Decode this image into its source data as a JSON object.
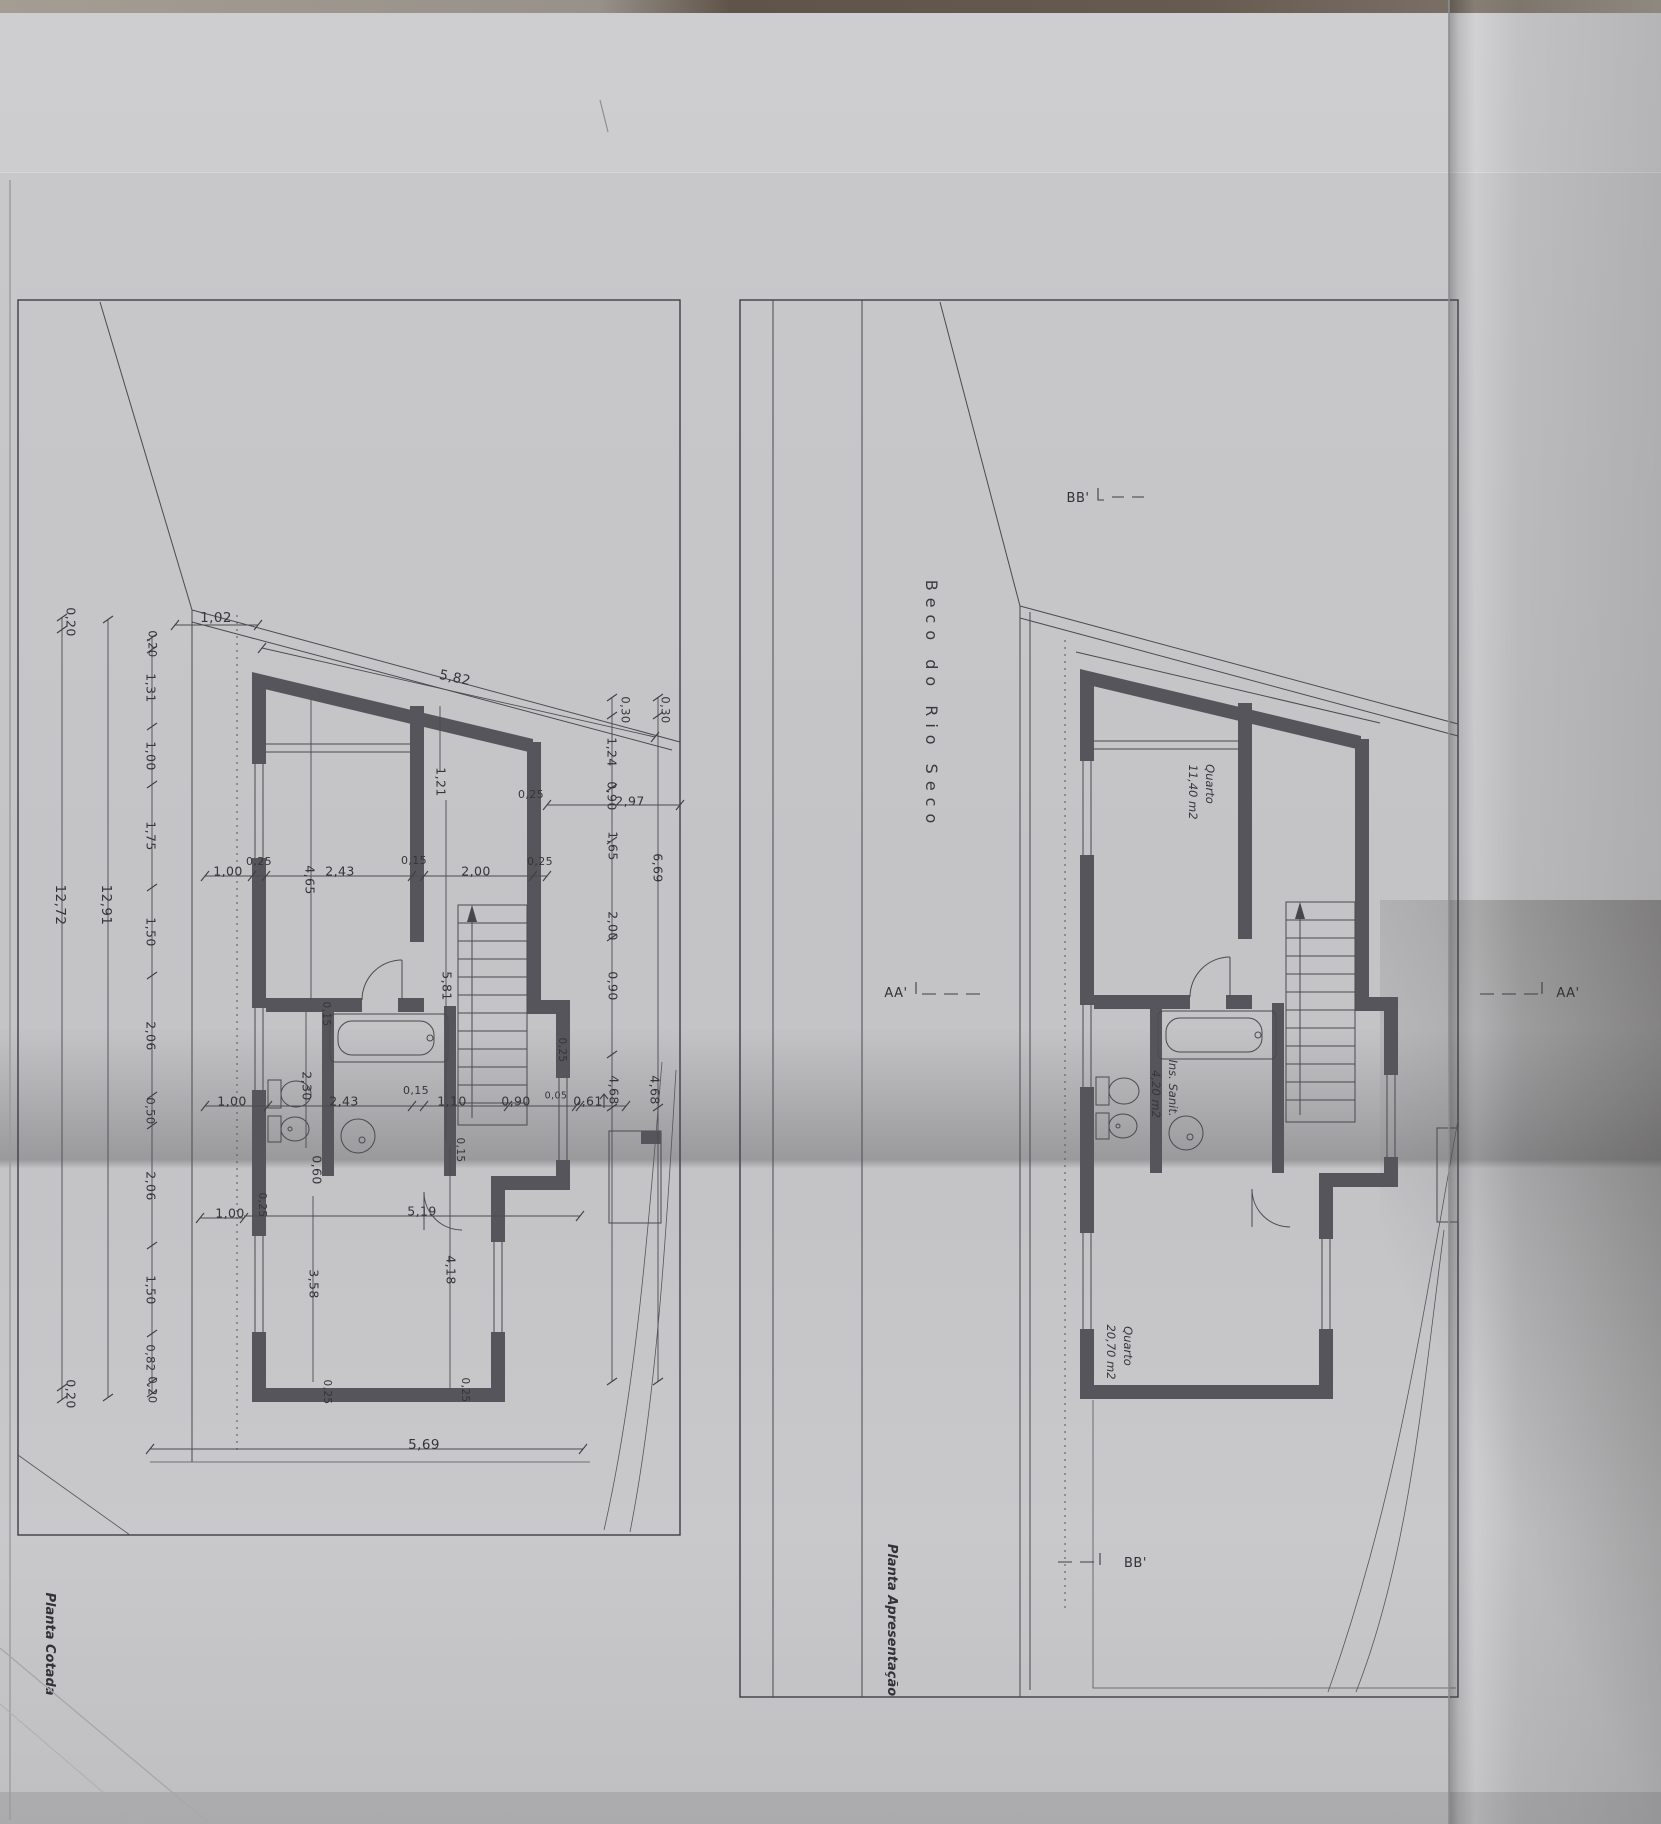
{
  "sheet": {
    "street_name": "Beco do Rio Seco"
  },
  "plans": {
    "left": {
      "title": "Planta Cotada",
      "dims": [
        {
          "t": "1,02",
          "x": 216,
          "y": 618,
          "r": 0,
          "fs": 13.5
        },
        {
          "t": "5,82",
          "x": 455,
          "y": 678,
          "r": 12,
          "fs": 13.5
        },
        {
          "t": "0,20",
          "x": 70,
          "y": 622,
          "r": 90
        },
        {
          "t": "12,72",
          "x": 60,
          "y": 905,
          "r": 90,
          "fs": 13.5
        },
        {
          "t": "12,91",
          "x": 106,
          "y": 905,
          "r": 90,
          "fs": 13.5
        },
        {
          "t": "0,20",
          "x": 152,
          "y": 644,
          "r": 90,
          "fs": 11.5
        },
        {
          "t": "1,31",
          "x": 150,
          "y": 688,
          "r": 90
        },
        {
          "t": "1,00",
          "x": 150,
          "y": 756,
          "r": 90
        },
        {
          "t": "1,75",
          "x": 150,
          "y": 836,
          "r": 90
        },
        {
          "t": "1,50",
          "x": 150,
          "y": 932,
          "r": 90
        },
        {
          "t": "2,06",
          "x": 150,
          "y": 1036,
          "r": 90
        },
        {
          "t": "0,50",
          "x": 150,
          "y": 1111,
          "r": 90,
          "fs": 11.5
        },
        {
          "t": "2,06",
          "x": 150,
          "y": 1186,
          "r": 90
        },
        {
          "t": "1,50",
          "x": 150,
          "y": 1290,
          "r": 90
        },
        {
          "t": "0,82",
          "x": 150,
          "y": 1358,
          "r": 90,
          "fs": 11.5
        },
        {
          "t": "0,20",
          "x": 152,
          "y": 1390,
          "r": 90,
          "fs": 11.5
        },
        {
          "t": "0,20",
          "x": 70,
          "y": 1394,
          "r": 90
        },
        {
          "t": "1,00",
          "x": 228,
          "y": 872,
          "r": 0
        },
        {
          "t": "0,25",
          "x": 259,
          "y": 862,
          "r": 0,
          "fs": 11
        },
        {
          "t": "4,65",
          "x": 309,
          "y": 880,
          "r": 90
        },
        {
          "t": "2,43",
          "x": 340,
          "y": 872,
          "r": 0
        },
        {
          "t": "0,15",
          "x": 414,
          "y": 861,
          "r": 0,
          "fs": 11
        },
        {
          "t": "2,00",
          "x": 476,
          "y": 872,
          "r": 0
        },
        {
          "t": "0,25",
          "x": 540,
          "y": 862,
          "r": 0,
          "fs": 11
        },
        {
          "t": "1,21",
          "x": 440,
          "y": 782,
          "r": 90
        },
        {
          "t": "0,25",
          "x": 531,
          "y": 795,
          "r": 0,
          "fs": 11
        },
        {
          "t": "2,97",
          "x": 630,
          "y": 802,
          "r": 0
        },
        {
          "t": "0,30",
          "x": 625,
          "y": 710,
          "r": 90,
          "fs": 11.5
        },
        {
          "t": "0,30",
          "x": 665,
          "y": 710,
          "r": 90,
          "fs": 11.5
        },
        {
          "t": "1,24",
          "x": 611,
          "y": 752,
          "r": 90
        },
        {
          "t": "0,90",
          "x": 611,
          "y": 796,
          "r": 90
        },
        {
          "t": "1,65",
          "x": 612,
          "y": 846,
          "r": 90
        },
        {
          "t": "6,69",
          "x": 657,
          "y": 868,
          "r": 90
        },
        {
          "t": "2,00",
          "x": 612,
          "y": 926,
          "r": 90
        },
        {
          "t": "0,90",
          "x": 612,
          "y": 986,
          "r": 90
        },
        {
          "t": "4,68",
          "x": 613,
          "y": 1090,
          "r": 90
        },
        {
          "t": "4,68",
          "x": 654,
          "y": 1090,
          "r": 90
        },
        {
          "t": "5,81",
          "x": 446,
          "y": 986,
          "r": 90
        },
        {
          "t": "2,30",
          "x": 306,
          "y": 1086,
          "r": 90
        },
        {
          "t": "0,15",
          "x": 326,
          "y": 1014,
          "r": 90,
          "fs": 10.5
        },
        {
          "t": "1,00",
          "x": 232,
          "y": 1102,
          "r": 0
        },
        {
          "t": "2,43",
          "x": 344,
          "y": 1102,
          "r": 0
        },
        {
          "t": "0,15",
          "x": 416,
          "y": 1091,
          "r": 0,
          "fs": 11
        },
        {
          "t": "1,10",
          "x": 452,
          "y": 1102,
          "r": 0
        },
        {
          "t": "0,90",
          "x": 516,
          "y": 1102,
          "r": 0
        },
        {
          "t": "0,05",
          "x": 556,
          "y": 1096,
          "r": 0,
          "fs": 9.5
        },
        {
          "t": "0,61",
          "x": 588,
          "y": 1102,
          "r": 0
        },
        {
          "t": "0,15",
          "x": 460,
          "y": 1150,
          "r": 90,
          "fs": 10.5
        },
        {
          "t": "0,60",
          "x": 316,
          "y": 1170,
          "r": 90
        },
        {
          "t": "0,25",
          "x": 262,
          "y": 1205,
          "r": 90,
          "fs": 10.5
        },
        {
          "t": "5,19",
          "x": 422,
          "y": 1212,
          "r": 0
        },
        {
          "t": "1,00",
          "x": 230,
          "y": 1214,
          "r": 0
        },
        {
          "t": "3,58",
          "x": 313,
          "y": 1284,
          "r": 90
        },
        {
          "t": "4,18",
          "x": 450,
          "y": 1270,
          "r": 90
        },
        {
          "t": "0,25",
          "x": 327,
          "y": 1392,
          "r": 90,
          "fs": 10.5
        },
        {
          "t": "0,25",
          "x": 465,
          "y": 1390,
          "r": 90,
          "fs": 10.5
        },
        {
          "t": "5,69",
          "x": 424,
          "y": 1445,
          "r": 0,
          "fs": 13.5
        },
        {
          "t": "0,25",
          "x": 562,
          "y": 1050,
          "r": 90,
          "fs": 10.5
        }
      ]
    },
    "right": {
      "title": "Planta Apresentação",
      "street": "Beco do Rio Seco",
      "rooms": [
        {
          "name": "Quarto",
          "area": "11,40 m2"
        },
        {
          "name": "Ins. Sanit.",
          "area": "4,20 m2"
        },
        {
          "name": "Quarto",
          "area": "20,70 m2"
        }
      ],
      "sections": [
        {
          "label": "BB'"
        },
        {
          "label": "AA'"
        },
        {
          "label": "AA'"
        },
        {
          "label": "BB'"
        }
      ]
    }
  }
}
